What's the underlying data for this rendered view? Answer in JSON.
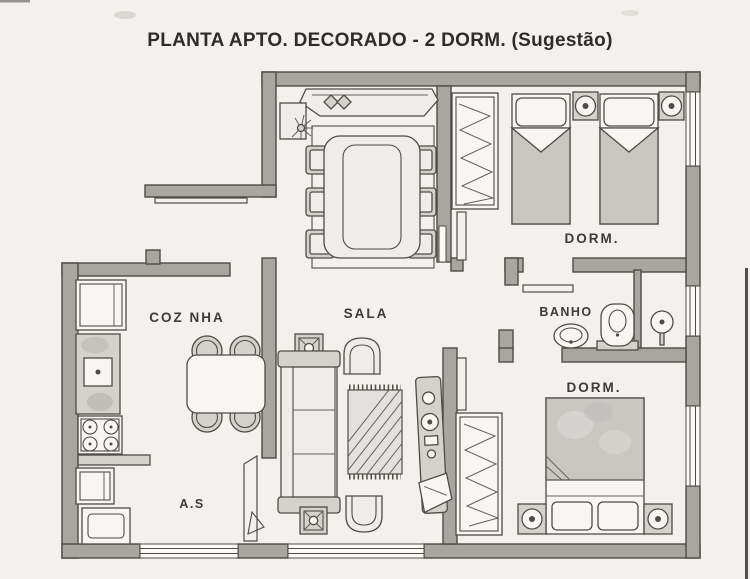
{
  "title": "PLANTA APTO. DECORADO - 2 DORM. (Sugestão)",
  "rooms": {
    "kitchen": {
      "label": "COZ NHA"
    },
    "service_area": {
      "label": "A.S"
    },
    "living_room": {
      "label": "SALA"
    },
    "bathroom": {
      "label": "BANHO"
    },
    "bedroom_top": {
      "label": "DORM."
    },
    "bedroom_bottom": {
      "label": "DORM."
    }
  },
  "colors": {
    "paper": "#f3f1ed",
    "wall": "#a8a6a1",
    "line": "#4e4c47",
    "furn-light": "#efede9",
    "furn-mid": "#d4d2cd",
    "blanket": "#c9c7c2",
    "label": "#3d3b37"
  }
}
